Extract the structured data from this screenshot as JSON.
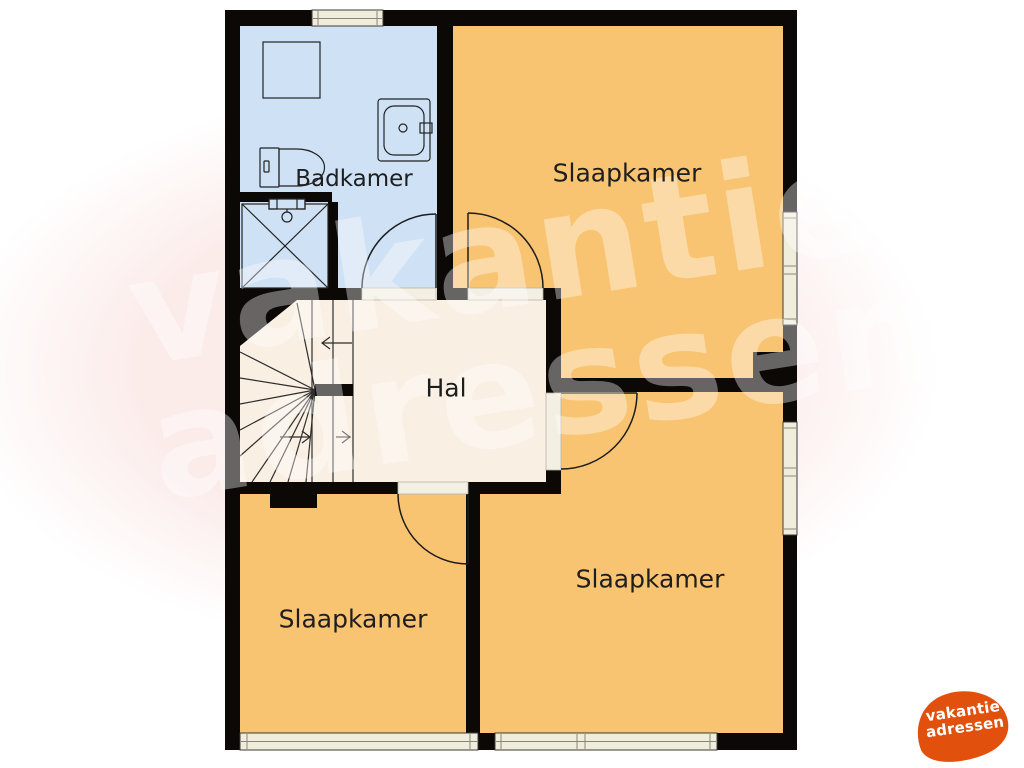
{
  "labels": {
    "badkamer": "Badkamer",
    "slaapkamer_top_right": "Slaapkamer",
    "hal": "Hal",
    "slaapkamer_bottom_left": "Slaapkamer",
    "slaapkamer_bottom_right": "Slaapkamer"
  },
  "watermark": {
    "line1": "vakantie",
    "line2": "adressen"
  },
  "logo": {
    "line1": "vakantie",
    "line2": "adressen"
  },
  "colors": {
    "bedroom_orange": "#f8c471",
    "bathroom_blue": "#cfe1f4",
    "hall_cream": "#f9efe2",
    "wall_black": "#0b0806",
    "window_fill": "#f1eddd",
    "logo_orange": "#e2500e",
    "background_blob_pink": "#fbecea"
  }
}
